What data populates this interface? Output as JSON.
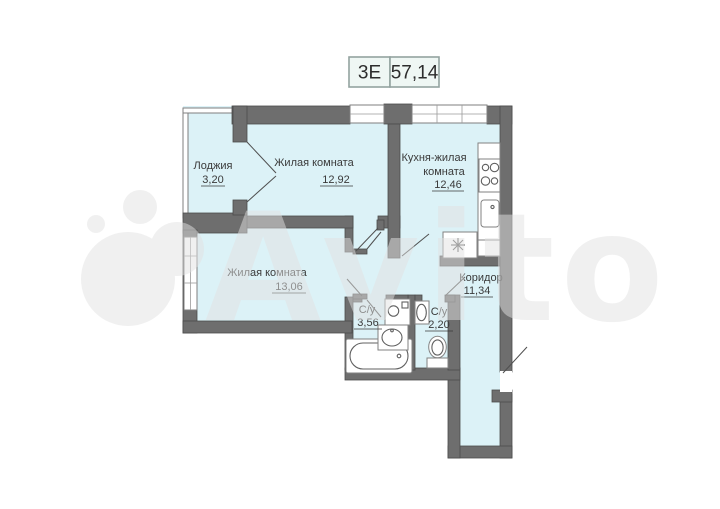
{
  "badge": {
    "type": "3Е",
    "area": "57,14"
  },
  "watermark": {
    "text": "Avito"
  },
  "rooms": {
    "loggia": {
      "name": "Лоджия",
      "area": "3,20"
    },
    "living1": {
      "name": "Жилая комната",
      "area": "12,92"
    },
    "kitchen": {
      "name_line1": "Кухня-жилая",
      "name_line2": "комната",
      "area": "12,46"
    },
    "living2": {
      "name": "Жилая комната",
      "area": "13,06"
    },
    "bath1": {
      "name": "С/у",
      "area": "3,56"
    },
    "bath2": {
      "name": "С/у",
      "area": "2,20"
    },
    "corridor": {
      "name": "Коридор",
      "area": "11,34"
    }
  },
  "fixtures": [
    "stove-icon",
    "kitchen-sink-icon",
    "utility-sink-icon",
    "bathtub-icon",
    "washing-machine-icon",
    "washbasin-icon",
    "toilet-icon"
  ],
  "colors": {
    "floor": "#dcf2f7",
    "wall": "#6e6e6e",
    "wall_outline": "#4c4c4c",
    "label": "#3a3a3a",
    "badge_border": "#93a3a0",
    "watermark": "#e2e2e2"
  }
}
